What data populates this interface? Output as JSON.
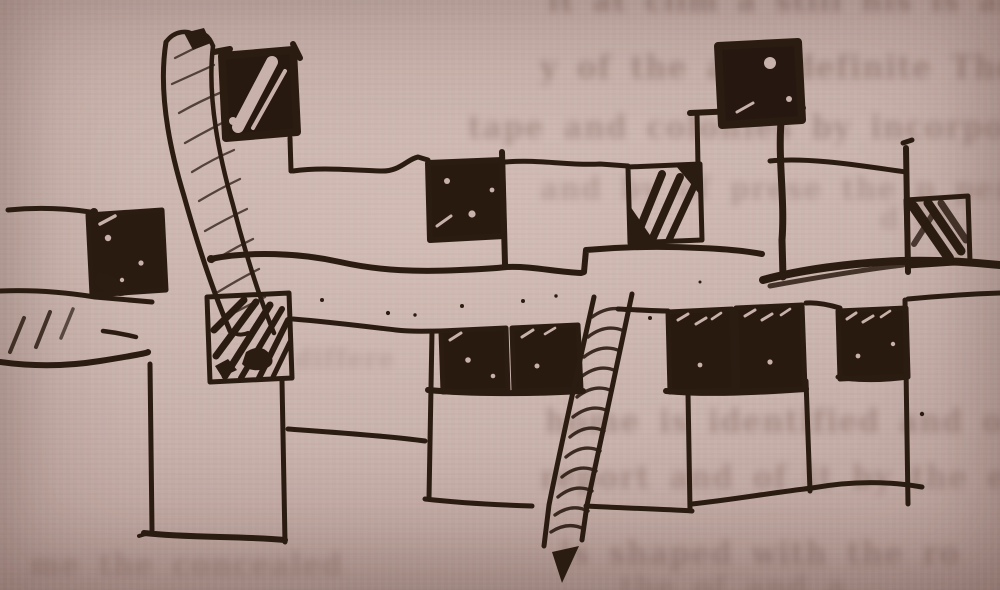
{
  "scene": {
    "description": "Photograph of a book page: a hand-drawn ink plan sketch of a linear building complex with a central pedestrian street, dark cross-hatched square courts, a leaning rope-hatched tower at upper left and a diagonal hatched path branching downward; faint printed text from the reverse side of the page shows through the pinkish paper.",
    "paper_color": "#cab3ad",
    "paper_edge_color": "#a2867f",
    "ink_color": "#2b1c12",
    "ghost_text_color": "#4d3126"
  },
  "sketch": {
    "title": "building-plan-sketch",
    "elements": [
      {
        "name": "leaning-tower",
        "description": "tall narrow tower with rope hatching, upper left, leaning right toward the street"
      },
      {
        "name": "tower-top-window",
        "description": "solid black square with a white diagonal stripe beside the tower top"
      },
      {
        "name": "left-wing",
        "description": "short wall stub with one dark scribble-hatched square at the far left"
      },
      {
        "name": "left-path",
        "description": "hatched path entering the street from the left page edge"
      },
      {
        "name": "upper-wing",
        "description": "long horizontal wing with two hatched squares along its top edge"
      },
      {
        "name": "upper-right-block",
        "description": "raised block carrying a black square window, long vertical wall drop"
      },
      {
        "name": "right-wing",
        "description": "right wing with one scribble-hatched square and a heavy shadowed lower edge"
      },
      {
        "name": "central-street",
        "description": "wide empty band of paper crossing the whole plan, flecked with ink dots"
      },
      {
        "name": "lower-wing",
        "description": "wing below the street with six dark hatched squares"
      },
      {
        "name": "diagonal-path",
        "description": "rope-hatched path branching from the street down to the page bottom, ending in an arrow tip"
      },
      {
        "name": "lower-rooms",
        "description": "four open rectangular rooms outlined below the lower wing"
      }
    ]
  },
  "ghost_text": {
    "lines": [
      {
        "text": "it at clim a still his is and for the most",
        "x": 548,
        "y": -16,
        "size": 28,
        "opacity": 0.32
      },
      {
        "text": "y of the a is definite The gave gives",
        "x": 540,
        "y": 50,
        "size": 29,
        "opacity": 0.3
      },
      {
        "text": "tape and colonies by incorporating with",
        "x": 468,
        "y": 110,
        "size": 29,
        "opacity": 0.27
      },
      {
        "text": "and by of prese the p peria",
        "x": 540,
        "y": 172,
        "size": 28,
        "opacity": 0.21
      },
      {
        "text": "d bl",
        "x": 880,
        "y": 205,
        "size": 26,
        "opacity": 0.17
      },
      {
        "text": "differe",
        "x": 295,
        "y": 344,
        "size": 24,
        "opacity": 0.15
      },
      {
        "text": "home is identified and only Inside an",
        "x": 545,
        "y": 404,
        "size": 29,
        "opacity": 0.27
      },
      {
        "text": "report and of it by the excess of th",
        "x": 540,
        "y": 460,
        "size": 29,
        "opacity": 0.25
      },
      {
        "text": "me the concealed",
        "x": 30,
        "y": 548,
        "size": 28,
        "opacity": 0.2
      },
      {
        "text": "is shaped with the ro",
        "x": 560,
        "y": 536,
        "size": 29,
        "opacity": 0.26
      },
      {
        "text": "the of and a",
        "x": 620,
        "y": 570,
        "size": 28,
        "opacity": 0.17
      }
    ]
  }
}
